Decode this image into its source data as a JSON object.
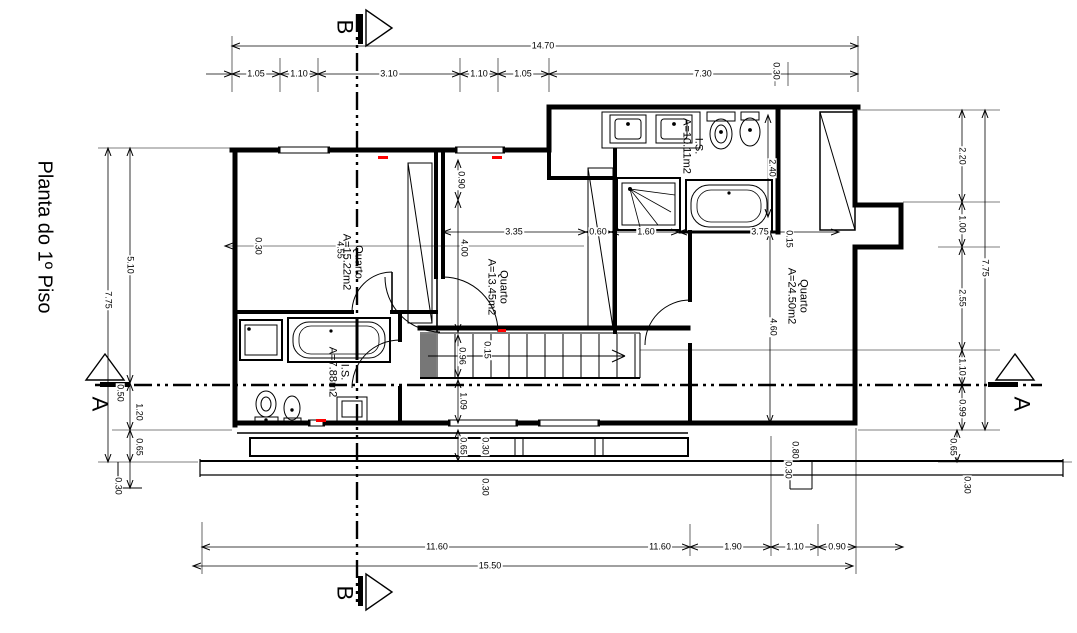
{
  "drawing": {
    "title": "Planta do 1º Piso"
  },
  "colors": {
    "background": "#ffffff",
    "line": "#000000",
    "accent_red": "#ff0000",
    "stair_block": "#777777"
  },
  "section_markers": [
    {
      "letter": "B",
      "x": 345,
      "y": 27
    },
    {
      "letter": "B",
      "x": 345,
      "y": 593
    },
    {
      "letter": "A",
      "x": 100,
      "y": 404
    },
    {
      "letter": "A",
      "x": 1022,
      "y": 404
    }
  ],
  "room_labels": [
    {
      "name": "Quarto",
      "area": "A=15.22m2",
      "x": 352,
      "y": 262
    },
    {
      "name": "Quarto",
      "area": "A=13.45m2",
      "x": 497,
      "y": 287
    },
    {
      "name": "Quarto",
      "area": "A=24.50m2",
      "x": 797,
      "y": 296
    },
    {
      "name": "I.S.",
      "area": "A=10.11m2",
      "x": 692,
      "y": 146
    },
    {
      "name": "I.S.",
      "area": "A=7.88m2",
      "x": 338,
      "y": 372
    }
  ],
  "dimension_labels": [
    {
      "text": "14.70",
      "x": 543,
      "y": 46,
      "rot": 0
    },
    {
      "text": "1.05",
      "x": 256,
      "y": 74,
      "rot": 0
    },
    {
      "text": "1.10",
      "x": 299,
      "y": 74,
      "rot": 0
    },
    {
      "text": "3.10",
      "x": 389,
      "y": 74,
      "rot": 0
    },
    {
      "text": "1.10",
      "x": 479,
      "y": 74,
      "rot": 0
    },
    {
      "text": "1.05",
      "x": 523,
      "y": 74,
      "rot": 0
    },
    {
      "text": "7.30",
      "x": 703,
      "y": 74,
      "rot": 0
    },
    {
      "text": "0.30",
      "x": 776,
      "y": 71,
      "rot": 1
    },
    {
      "text": "5.10",
      "x": 130,
      "y": 265,
      "rot": 1
    },
    {
      "text": "7.75",
      "x": 108,
      "y": 300,
      "rot": 1
    },
    {
      "text": "0.50",
      "x": 120,
      "y": 393,
      "rot": 1
    },
    {
      "text": "1.20",
      "x": 139,
      "y": 412,
      "rot": 1
    },
    {
      "text": "0.65",
      "x": 139,
      "y": 447,
      "rot": 1
    },
    {
      "text": "0.30",
      "x": 118,
      "y": 486,
      "rot": 1
    },
    {
      "text": "2.20",
      "x": 962,
      "y": 156,
      "rot": 1
    },
    {
      "text": "1.00",
      "x": 962,
      "y": 224,
      "rot": 1
    },
    {
      "text": "2.55",
      "x": 962,
      "y": 298,
      "rot": 1
    },
    {
      "text": "1.10",
      "x": 962,
      "y": 367,
      "rot": 1
    },
    {
      "text": "0.99",
      "x": 962,
      "y": 408,
      "rot": 1
    },
    {
      "text": "7.75",
      "x": 985,
      "y": 268,
      "rot": 1
    },
    {
      "text": "0.65",
      "x": 953,
      "y": 447,
      "rot": 1
    },
    {
      "text": "0.30",
      "x": 967,
      "y": 485,
      "rot": 1
    },
    {
      "text": "0.30",
      "x": 258,
      "y": 246,
      "rot": 1
    },
    {
      "text": "4.55",
      "x": 340,
      "y": 250,
      "rot": 1
    },
    {
      "text": "0.90",
      "x": 461,
      "y": 180,
      "rot": 1
    },
    {
      "text": "3.35",
      "x": 514,
      "y": 232,
      "rot": 0
    },
    {
      "text": "0.60",
      "x": 598,
      "y": 232,
      "rot": 0
    },
    {
      "text": "1.60",
      "x": 646,
      "y": 232,
      "rot": 0
    },
    {
      "text": "3.75",
      "x": 760,
      "y": 232,
      "rot": 0
    },
    {
      "text": "4.00",
      "x": 464,
      "y": 248,
      "rot": 1
    },
    {
      "text": "0.15",
      "x": 487,
      "y": 350,
      "rot": 1
    },
    {
      "text": "0.96",
      "x": 462,
      "y": 356,
      "rot": 1
    },
    {
      "text": "1.09",
      "x": 463,
      "y": 401,
      "rot": 1
    },
    {
      "text": "0.65",
      "x": 463,
      "y": 446,
      "rot": 1
    },
    {
      "text": "0.30",
      "x": 485,
      "y": 446,
      "rot": 1
    },
    {
      "text": "0.30",
      "x": 485,
      "y": 487,
      "rot": 1
    },
    {
      "text": "2.40",
      "x": 772,
      "y": 168,
      "rot": 1
    },
    {
      "text": "0.15",
      "x": 789,
      "y": 239,
      "rot": 1
    },
    {
      "text": "4.60",
      "x": 773,
      "y": 327,
      "rot": 1
    },
    {
      "text": "0.80",
      "x": 795,
      "y": 450,
      "rot": 1
    },
    {
      "text": "0.30",
      "x": 788,
      "y": 470,
      "rot": 1
    },
    {
      "text": "11.60",
      "x": 437,
      "y": 547,
      "rot": 0
    },
    {
      "text": "11.60",
      "x": 660,
      "y": 547,
      "rot": 0
    },
    {
      "text": "1.90",
      "x": 733,
      "y": 547,
      "rot": 0
    },
    {
      "text": "1.10",
      "x": 795,
      "y": 547,
      "rot": 0
    },
    {
      "text": "0.90",
      "x": 837,
      "y": 547,
      "rot": 0
    },
    {
      "text": "15.50",
      "x": 490,
      "y": 566,
      "rot": 0
    }
  ]
}
